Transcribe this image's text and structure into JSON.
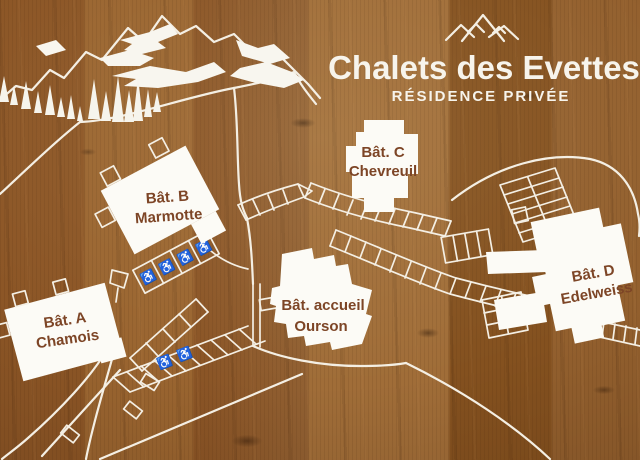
{
  "sign": {
    "title": "Chalets des Evettes",
    "subtitle": "RÉSIDENCE PRIVÉE"
  },
  "buildings": [
    {
      "id": "a",
      "label": "Bât. A",
      "name": "Chamois"
    },
    {
      "id": "b",
      "label": "Bât. B",
      "name": "Marmotte"
    },
    {
      "id": "c",
      "label": "Bât. C",
      "name": "Chevreuil"
    },
    {
      "id": "accueil",
      "label": "Bât. accueil",
      "name": "Ourson"
    },
    {
      "id": "d",
      "label": "Bât. D",
      "name": "Edelweiss"
    }
  ],
  "icons": {
    "accessible_parking": "♿",
    "mountain_logo": "three-peaks",
    "scene": [
      "mountain-ridge",
      "snow-patches",
      "pine-trees"
    ]
  },
  "colors": {
    "line": "#f4efe4",
    "building_fill": "#fcfbf6",
    "label_brown": "#7d4526",
    "wood_mid": "#8f5b2b"
  }
}
